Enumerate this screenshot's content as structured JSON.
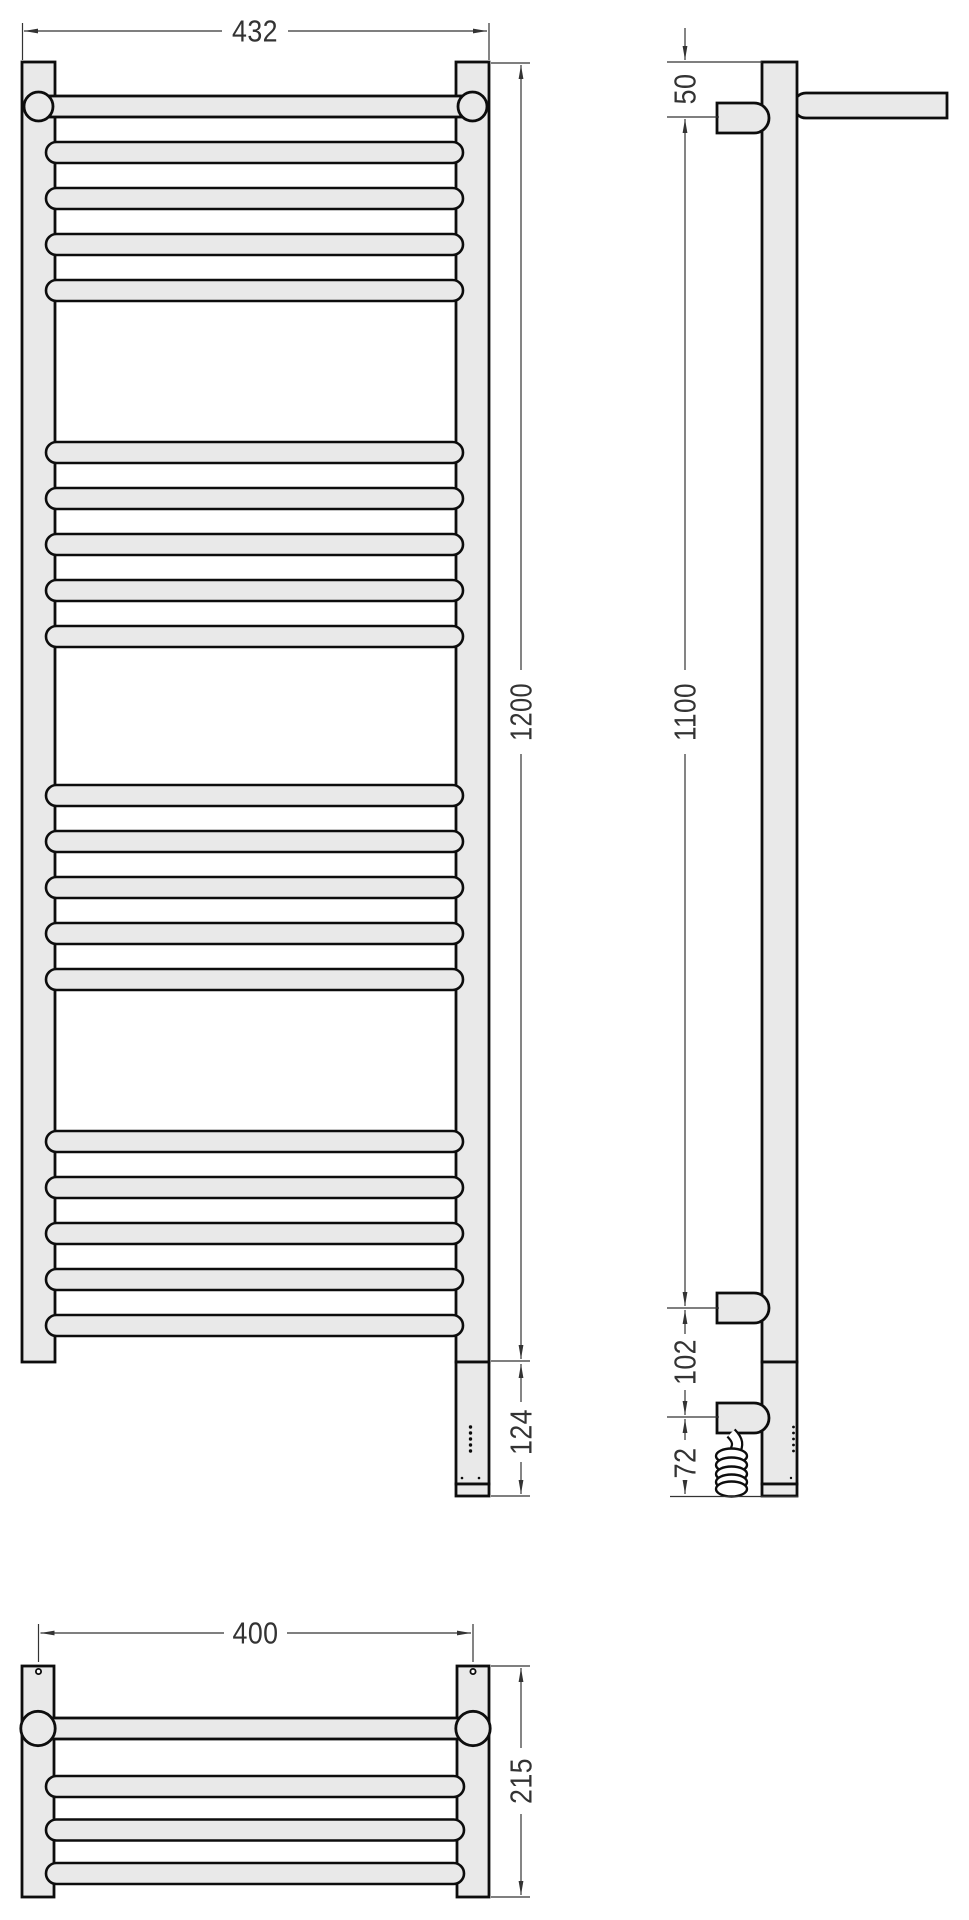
{
  "front_view": {
    "overall_width": "432",
    "overall_height": "1200",
    "heater_length": "124"
  },
  "side_view": {
    "top_to_bracket": "50",
    "bracket_span": "1100",
    "bracket_to_heater_mount": "102",
    "heater_mount_to_end": "72"
  },
  "top_view": {
    "mount_spacing": "400",
    "depth": "215"
  },
  "colors": {
    "metal_fill": "#e9e9e9",
    "outline": "#0d0d0d",
    "dimension": "#333333",
    "background": "#ffffff"
  }
}
